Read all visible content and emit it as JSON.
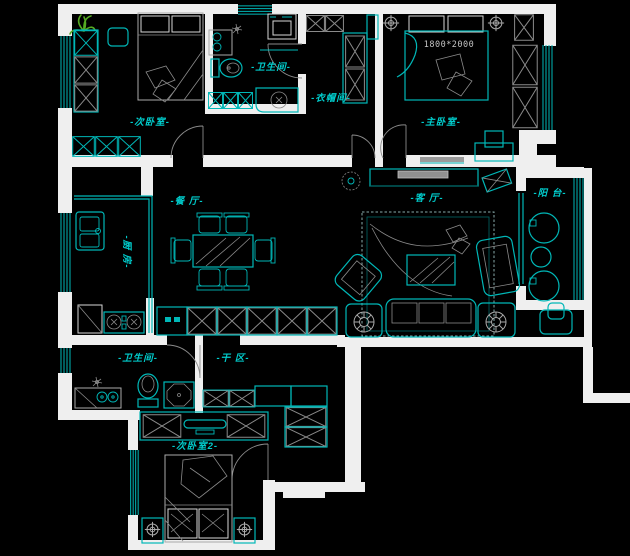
{
  "colors": {
    "bg": "#000000",
    "wall": "#efefef",
    "line": "#00b7b7",
    "gray": "#aaaaaa",
    "gray_dim": "#8a8a8a",
    "label": "#00cdcd",
    "dim_text": "#c4c4c4",
    "green": "#55aa22"
  },
  "rooms": {
    "bedroom1": {
      "label": "-次卧室-"
    },
    "bathroom1": {
      "label": "-卫生间-"
    },
    "cloakroom": {
      "label": "-衣帽间-"
    },
    "master": {
      "label": "-主卧室-"
    },
    "dining": {
      "label": "-餐 厅-"
    },
    "kitchen": {
      "label": "-厨 房-"
    },
    "living": {
      "label": "-客 厅-"
    },
    "balcony": {
      "label": "-阳 台-"
    },
    "bathroom2": {
      "label": "-卫生间-"
    },
    "dry_area": {
      "label": "-干 区-"
    },
    "bedroom2": {
      "label": "-次卧室2-"
    }
  },
  "annotations": {
    "master_bed_size": "1800*2000"
  }
}
